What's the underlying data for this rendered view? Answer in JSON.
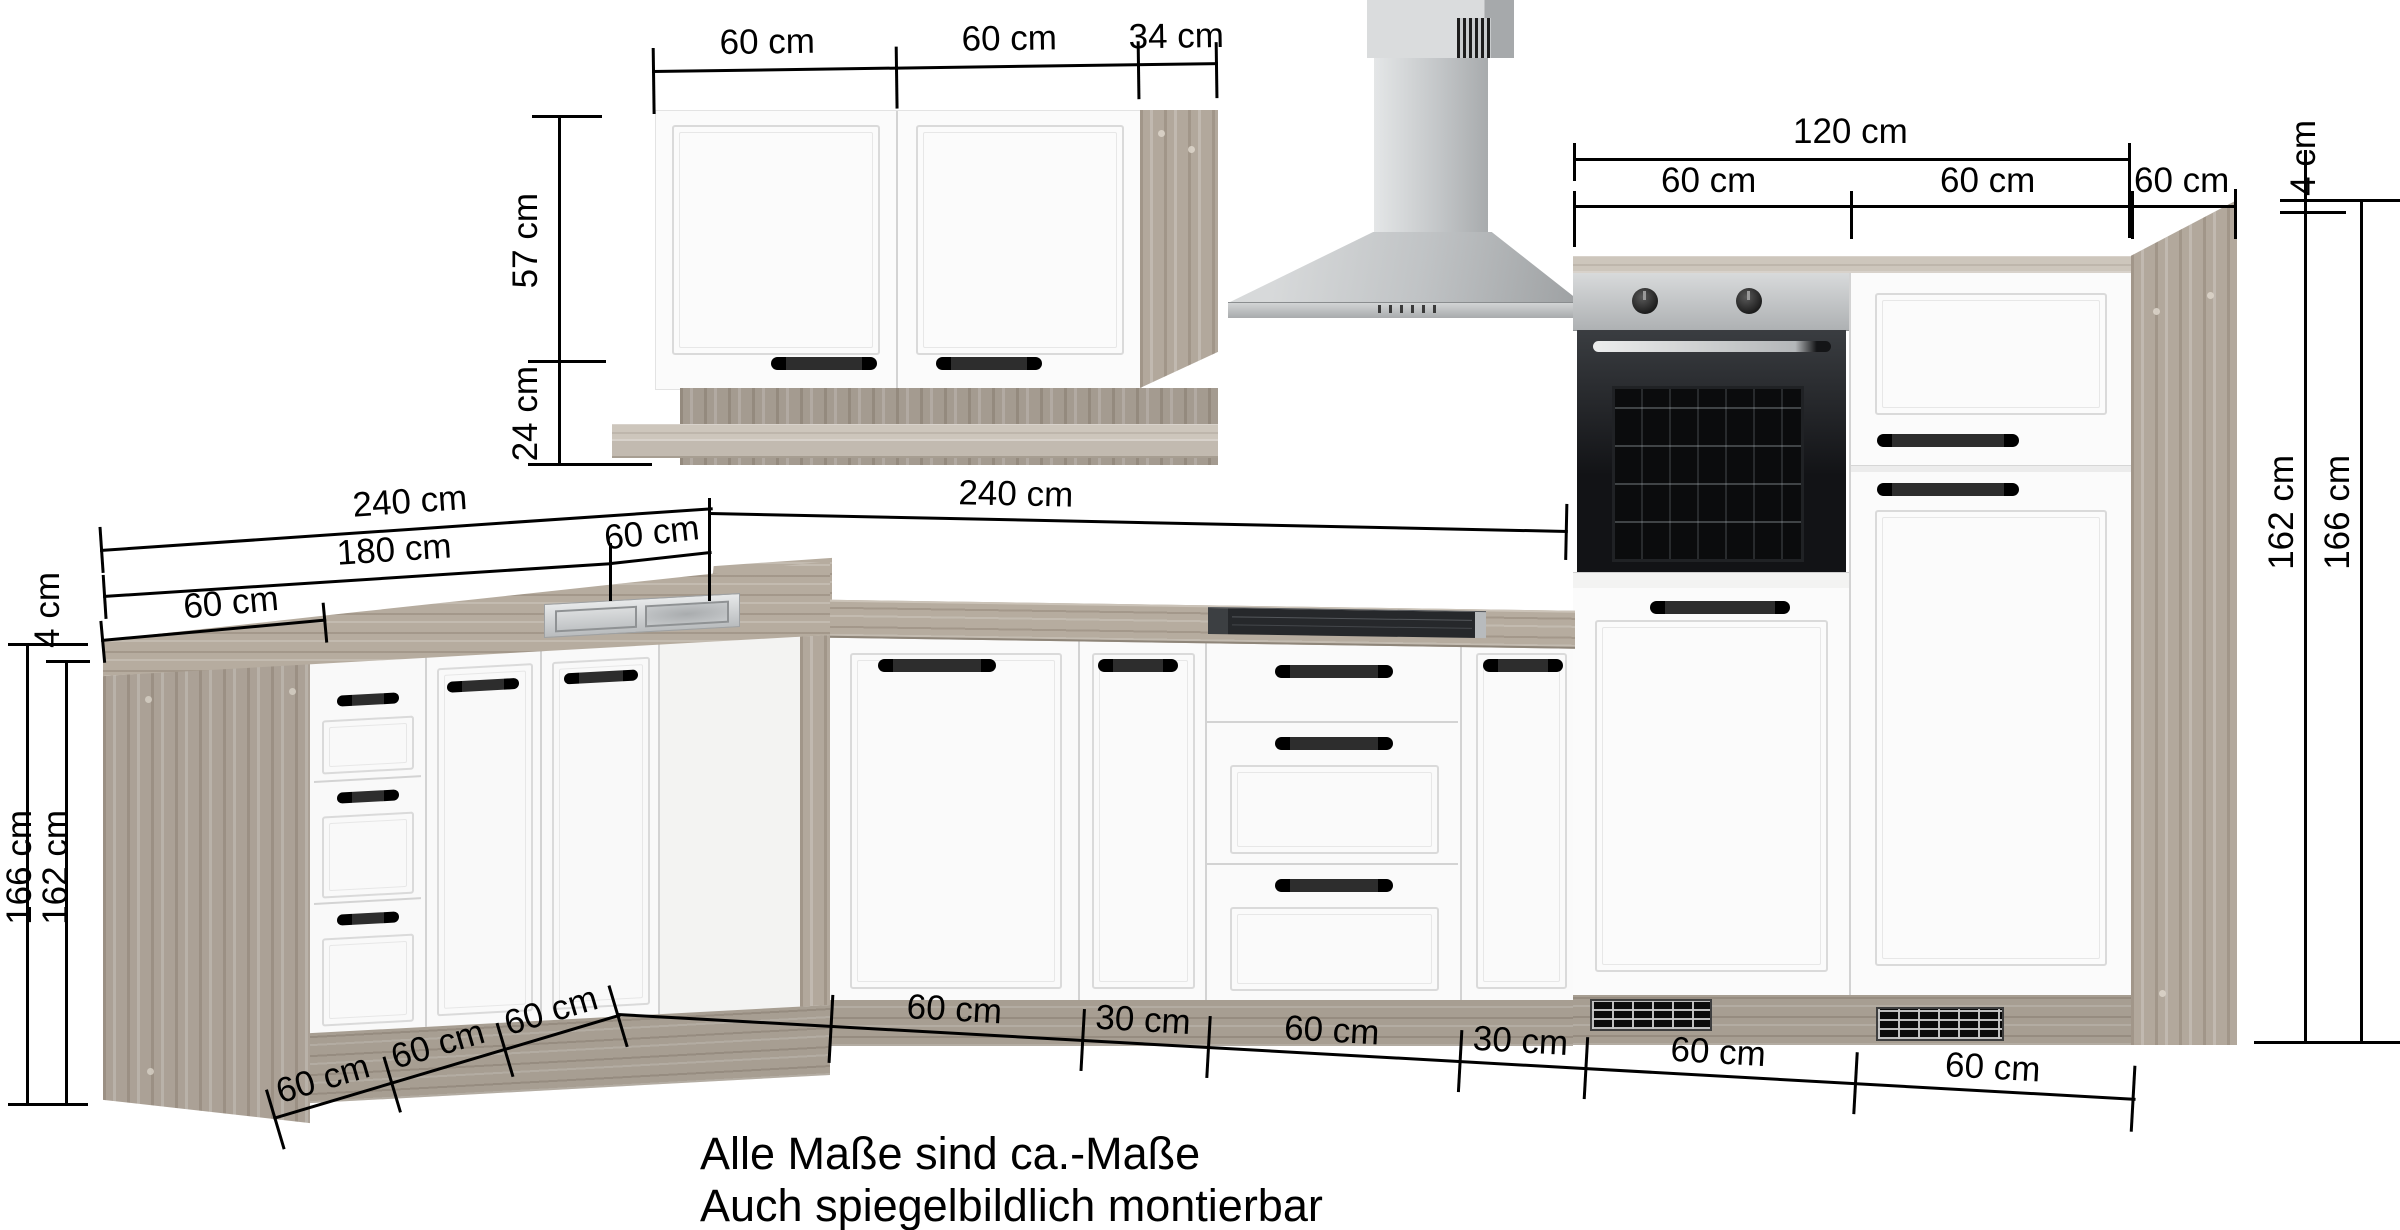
{
  "notes": {
    "line1": "Alle Maße sind ca.-Maße",
    "line2": "Auch spiegelbildlich montierbar"
  },
  "dims": {
    "wall_top": [
      "60 cm",
      "60 cm",
      "34 cm"
    ],
    "wall_height": "57 cm",
    "wall_shelf_height": "24 cm",
    "tall_total": "120 cm",
    "tall_segments": [
      "60 cm",
      "60 cm",
      "60 cm"
    ],
    "tall_right": {
      "worktop": "4 cm",
      "carcass": "162 cm",
      "total": "166 cm"
    },
    "base_left": {
      "worktop": "4 cm",
      "total_height": "166 cm",
      "carcass_height": "162 cm",
      "run_total": "240 cm",
      "run_cabinets": "180 cm",
      "run_depth": "60 cm"
    },
    "corner_width": "60 cm",
    "base_right_total": "240 cm",
    "bottom_left_segments": [
      "60 cm",
      "60 cm",
      "60 cm"
    ],
    "bottom_right_segments": [
      "60 cm",
      "30 cm",
      "60 cm",
      "30 cm",
      "60 cm",
      "60 cm"
    ]
  },
  "colors": {
    "wood": "#b3a99d",
    "wood_light": "#cdc6bc",
    "front_white": "#fbfbfb",
    "steel": "#c4c7c9",
    "appliance_dark": "#1a1c1f",
    "dim_line": "#000000"
  }
}
